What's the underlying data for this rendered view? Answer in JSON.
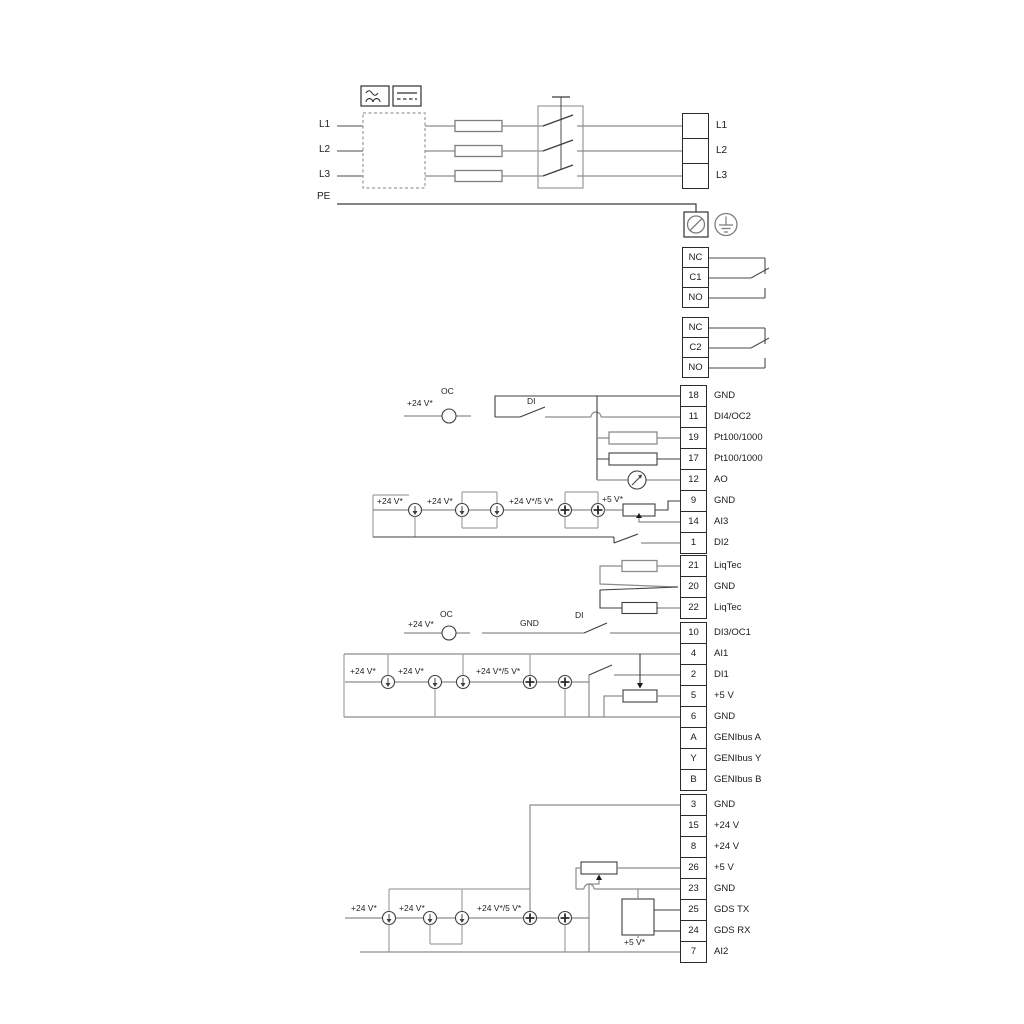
{
  "power_in": {
    "l1": "L1",
    "l2": "L2",
    "l3": "L3",
    "pe": "PE"
  },
  "power_out": [
    {
      "label": "L1"
    },
    {
      "label": "L2"
    },
    {
      "label": "L3"
    }
  ],
  "relay1": [
    {
      "num": "NC"
    },
    {
      "num": "C1"
    },
    {
      "num": "NO"
    }
  ],
  "relay2": [
    {
      "num": "NC"
    },
    {
      "num": "C2"
    },
    {
      "num": "NO"
    }
  ],
  "io1": [
    {
      "num": "18",
      "label": "GND"
    },
    {
      "num": "11",
      "label": "DI4/OC2"
    },
    {
      "num": "19",
      "label": "Pt100/1000"
    },
    {
      "num": "17",
      "label": "Pt100/1000"
    },
    {
      "num": "12",
      "label": "AO"
    },
    {
      "num": "9",
      "label": "GND"
    },
    {
      "num": "14",
      "label": "AI3"
    },
    {
      "num": "1",
      "label": "DI2"
    }
  ],
  "liqtec": [
    {
      "num": "21",
      "label": "LiqTec"
    },
    {
      "num": "20",
      "label": "GND"
    },
    {
      "num": "22",
      "label": "LiqTec"
    }
  ],
  "io2": [
    {
      "num": "10",
      "label": "DI3/OC1"
    },
    {
      "num": "4",
      "label": "AI1"
    },
    {
      "num": "2",
      "label": "DI1"
    },
    {
      "num": "5",
      "label": "+5 V"
    },
    {
      "num": "6",
      "label": "GND"
    },
    {
      "num": "A",
      "label": "GENIbus A"
    },
    {
      "num": "Y",
      "label": "GENIbus Y"
    },
    {
      "num": "B",
      "label": "GENIbus B"
    }
  ],
  "io3": [
    {
      "num": "3",
      "label": "GND"
    },
    {
      "num": "15",
      "label": "+24 V"
    },
    {
      "num": "8",
      "label": "+24 V"
    },
    {
      "num": "26",
      "label": "+5 V"
    },
    {
      "num": "23",
      "label": "GND"
    },
    {
      "num": "25",
      "label": "GDS TX"
    },
    {
      "num": "24",
      "label": "GDS RX"
    },
    {
      "num": "7",
      "label": "AI2"
    }
  ],
  "annot": {
    "oc": "OC",
    "di": "DI",
    "gnd": "GND",
    "v24": "+24 V*",
    "v24_5": "+24 V*/5 V*",
    "v5": "+5 V*"
  }
}
